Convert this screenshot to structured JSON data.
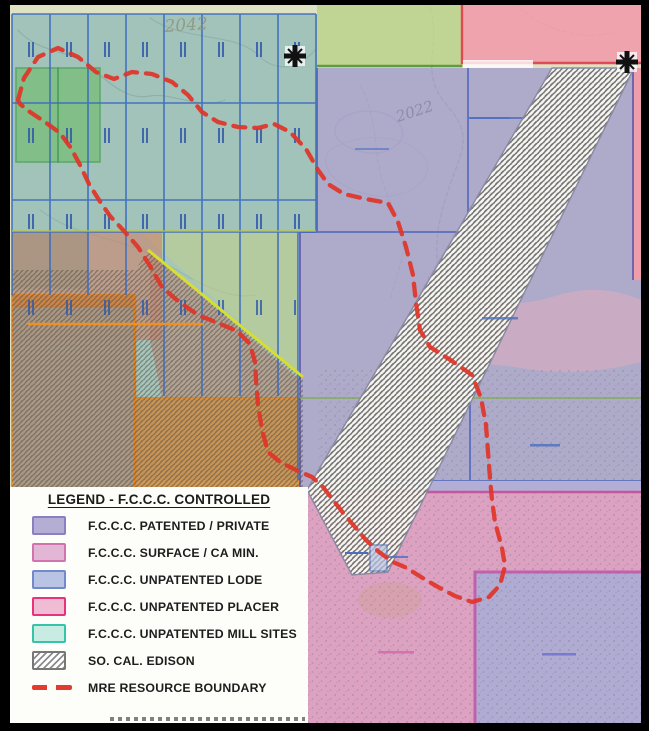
{
  "map": {
    "description": "Mining claims ownership map with topographic background",
    "labels": {
      "elev_2042": "2042",
      "elev_2022": "2022"
    },
    "icons": {
      "section_corner_nw": "survey-cross-marker",
      "section_corner_ne": "survey-cross-marker"
    },
    "colors": {
      "topo_base": "#dfe2c2",
      "patented_private_area": "#a49ecb",
      "surface_ca_min_area": "#dc9ec2",
      "unpatented_lode_claims": "#6fa9b4",
      "unpatented_placer_area": "#ef9dab",
      "mill_site_green": "#74bd74",
      "orange_parcels": "#e8821c",
      "edison_hatch": "#72716d",
      "mre_boundary_red": "#e03428",
      "grid_blue": "#3a6abf",
      "diagonal_yellow": "#d6de2f"
    }
  },
  "legend": {
    "title": "LEGEND - F.C.C.C. CONTROLLED",
    "items": [
      {
        "label": "F.C.C.C. PATENTED / PRIVATE",
        "fill": "#b5aed4",
        "border": "#8a7fc0",
        "type": "fill"
      },
      {
        "label": "F.C.C.C. SURFACE / CA MIN.",
        "fill": "#e2b6d4",
        "border": "#d173ae",
        "type": "fill"
      },
      {
        "label": "F.C.C.C. UNPATENTED LODE",
        "fill": "#b9c4e4",
        "border": "#7389cd",
        "type": "fill"
      },
      {
        "label": "F.C.C.C. UNPATENTED PLACER",
        "fill": "#f0bcd4",
        "border": "#e8327c",
        "type": "fill"
      },
      {
        "label": "F.C.C.C. UNPATENTED MILL SITES",
        "fill": "#c9ece2",
        "border": "#35c4aa",
        "type": "fill"
      },
      {
        "label": "SO. CAL. EDISON",
        "fill": "#ffffff",
        "border": "#777777",
        "type": "hatch"
      },
      {
        "label": "MRE RESOURCE BOUNDARY",
        "fill": "#e23c2e",
        "type": "dash"
      }
    ]
  }
}
